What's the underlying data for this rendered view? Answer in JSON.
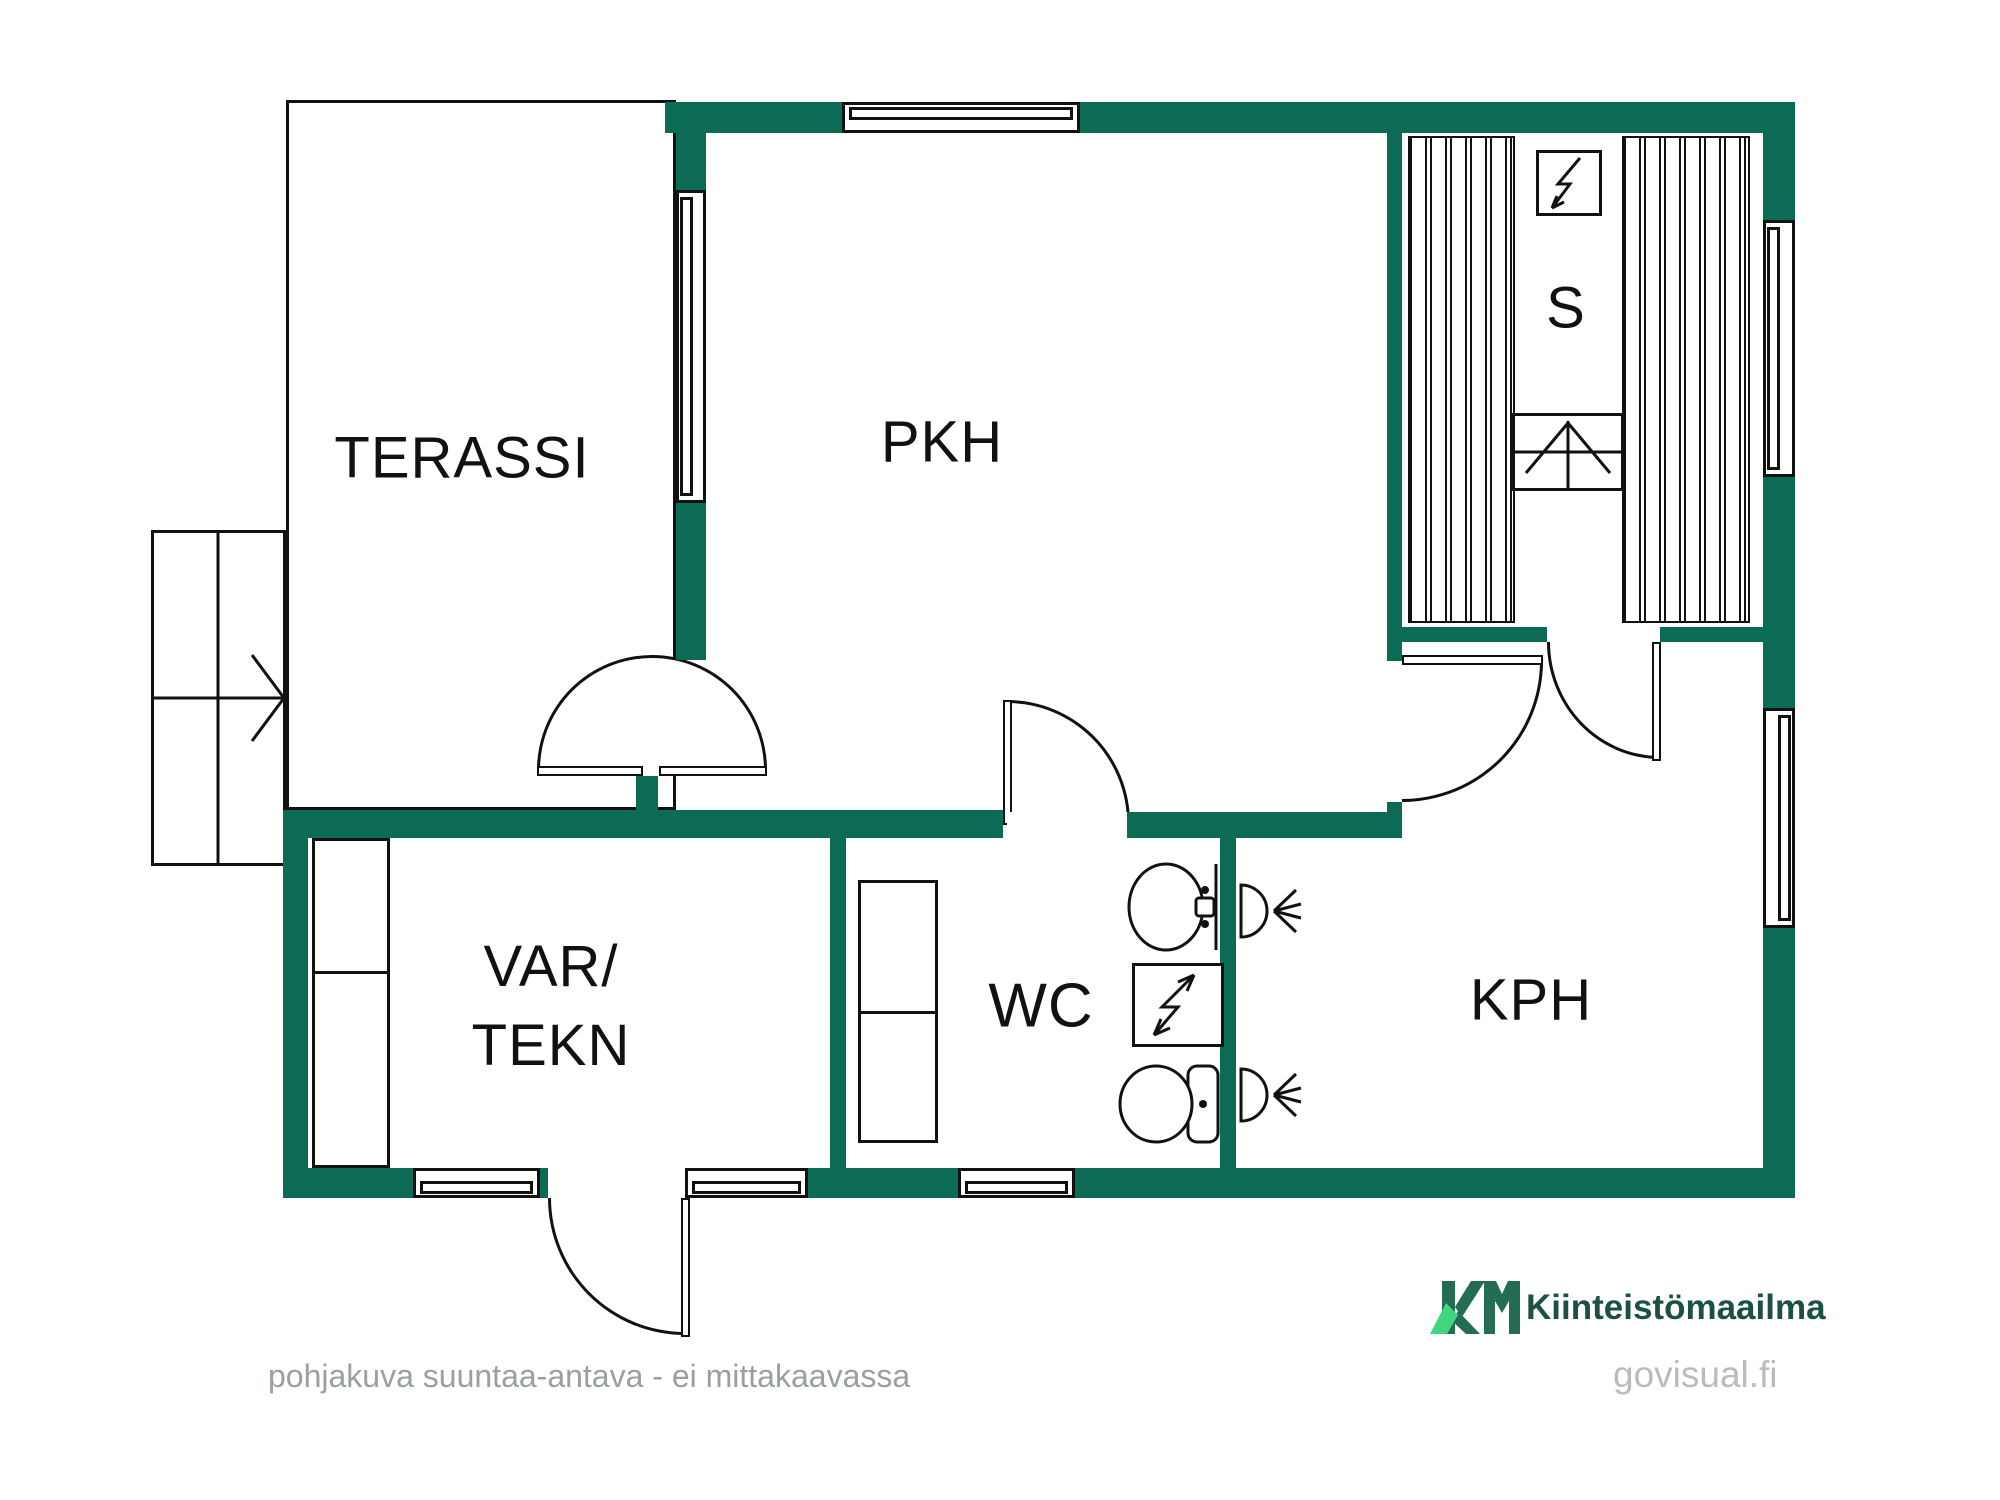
{
  "colors": {
    "wall": "#0c6b55",
    "line": "#111111",
    "footer": "#9aa0a2",
    "brand_dark": "#256c54",
    "brand_light": "#40d57f",
    "brand_text": "#1d5044",
    "govisual": "#b9bcbe"
  },
  "rooms": {
    "terassi": "TERASSI",
    "pkh": "PKH",
    "sauna": "S",
    "var_line1": "VAR/",
    "var_line2": "TEKN",
    "wc": "WC",
    "kph": "KPH"
  },
  "icons": {
    "sauna_stove": "lightning-bolt",
    "electric_panel": "lightning-bolt",
    "showers": "shower-head",
    "sink": "washbasin",
    "toilet": "toilet",
    "stairs": "arrow-right",
    "sauna_step": "arrow-up"
  },
  "footer": {
    "disclaimer": "pohjakuva suuntaa-antava - ei mittakaavassa"
  },
  "branding": {
    "logo": "KM",
    "company": "Kiinteistömaailma",
    "website": "govisual.fi"
  }
}
